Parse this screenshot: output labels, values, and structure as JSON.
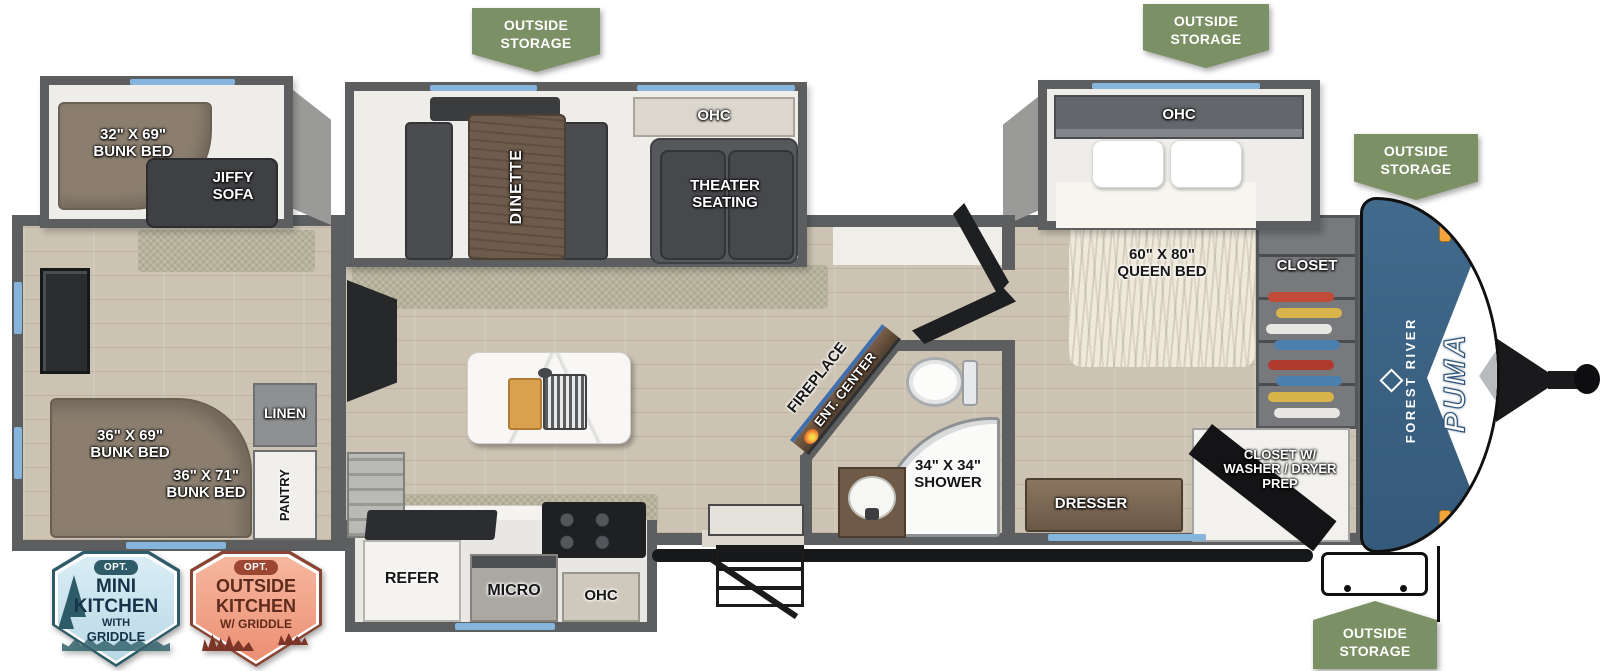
{
  "brand": {
    "maker": "FOREST RIVER",
    "model": "PUMA"
  },
  "colors": {
    "badge_green": "#7C9065",
    "cap_blue": "#3B6384",
    "window_blue": "#85B4DD",
    "wall_gray": "#5C5E60",
    "mini_badge_teal": "#2E5B68",
    "outside_badge_rust": "#8A4434"
  },
  "storage_badges": {
    "top_left": "OUTSIDE\nSTORAGE",
    "top_right": "OUTSIDE\nSTORAGE",
    "front_right": "OUTSIDE\nSTORAGE",
    "bottom_front": "OUTSIDE\nSTORAGE"
  },
  "option_badges": {
    "mini_kitchen": {
      "opt": "OPT.",
      "line1": "MINI",
      "line2": "KITCHEN",
      "line3": "WITH",
      "line4": "GRIDDLE"
    },
    "outside_kitchen": {
      "opt": "OPT.",
      "line1": "OUTSIDE",
      "line2": "KITCHEN",
      "line3": "W/ GRIDDLE"
    }
  },
  "bunkhouse": {
    "bunk_slide_label": "32\" X 69\"\nBUNK BED",
    "jiffy_sofa": "JIFFY\nSOFA",
    "bunk1": "36\" X 69\"\nBUNK BED",
    "bunk2": "36\" X 71\"\nBUNK BED",
    "linen": "LINEN",
    "pantry": "PANTRY"
  },
  "living": {
    "dinette": "DINETTE",
    "ohc": "OHC",
    "theater": "THEATER\nSEATING",
    "fireplace": "FIREPLACE",
    "ent_center": "ENT. CENTER"
  },
  "kitchen": {
    "refer": "REFER",
    "micro": "MICRO",
    "ohc": "OHC"
  },
  "bathroom": {
    "shower": "34\" X 34\"\nSHOWER"
  },
  "bedroom": {
    "ohc": "OHC",
    "queen_bed": "60\" X 80\"\nQUEEN BED",
    "closet": "CLOSET",
    "dresser": "DRESSER",
    "washer_dryer_closet": "CLOSET W/\nWASHER / DRYER\nPREP"
  }
}
